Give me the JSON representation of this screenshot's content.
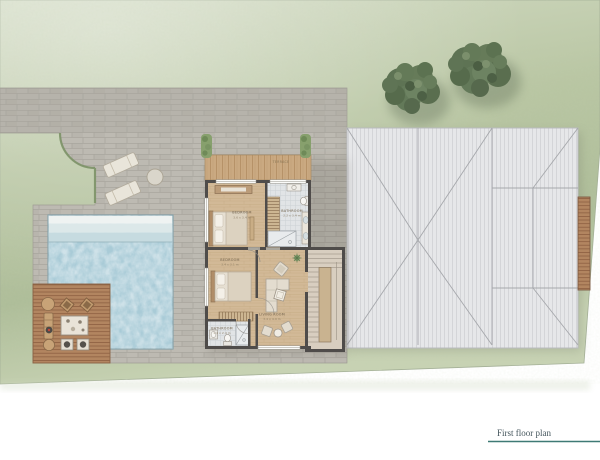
{
  "title": {
    "label": "First floor plan"
  },
  "plan": {
    "rooms": [
      {
        "id": "terrace",
        "label": "TERRACE",
        "dims": ""
      },
      {
        "id": "master-bedroom",
        "label": "BEDROOM",
        "dims": "3.6 x 3.4 m"
      },
      {
        "id": "bathroom-1",
        "label": "BATHROOM",
        "dims": "2.2 x 3.4 m"
      },
      {
        "id": "bedroom-2",
        "label": "BEDROOM",
        "dims": "3.4 x 3.1 m"
      },
      {
        "id": "living-room",
        "label": "LIVING ROOM",
        "dims": "3.4 x 4.9 m"
      },
      {
        "id": "bathroom-2",
        "label": "BATHROOM",
        "dims": "1.4 x 2.4 m"
      }
    ]
  },
  "palette": {
    "grass": "#b7c4a2",
    "paving": "#bdbab2",
    "pool_water": "#a9cbd7",
    "deck_wood": "#b28560",
    "porch_wood": "#caa981",
    "interior_floor": "#d2b997",
    "tile": "#e1e4e6",
    "wall": "#4f4c4a",
    "roof": "#e6e7e9",
    "tree": "#5e7354",
    "accent_underline": "#3e7a75",
    "title_ink": "#44555c"
  }
}
